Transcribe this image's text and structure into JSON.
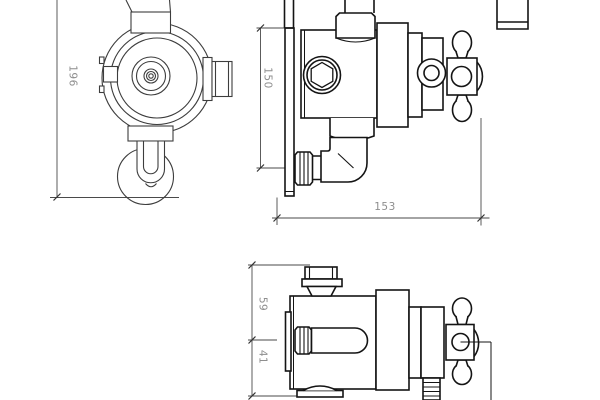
{
  "drawing": {
    "background": "#ffffff",
    "outline_color": "#141414",
    "front_outline_color": "#3d3d3d",
    "dimension_line_color": "#4a4a4a",
    "dimension_tick_color": "#333333",
    "dimension_text_color": "#8e8e8e",
    "dimensions": {
      "front_height": "196",
      "side_height": "150",
      "side_depth": "153",
      "bottom_upper": "59",
      "bottom_lower": "41"
    }
  }
}
